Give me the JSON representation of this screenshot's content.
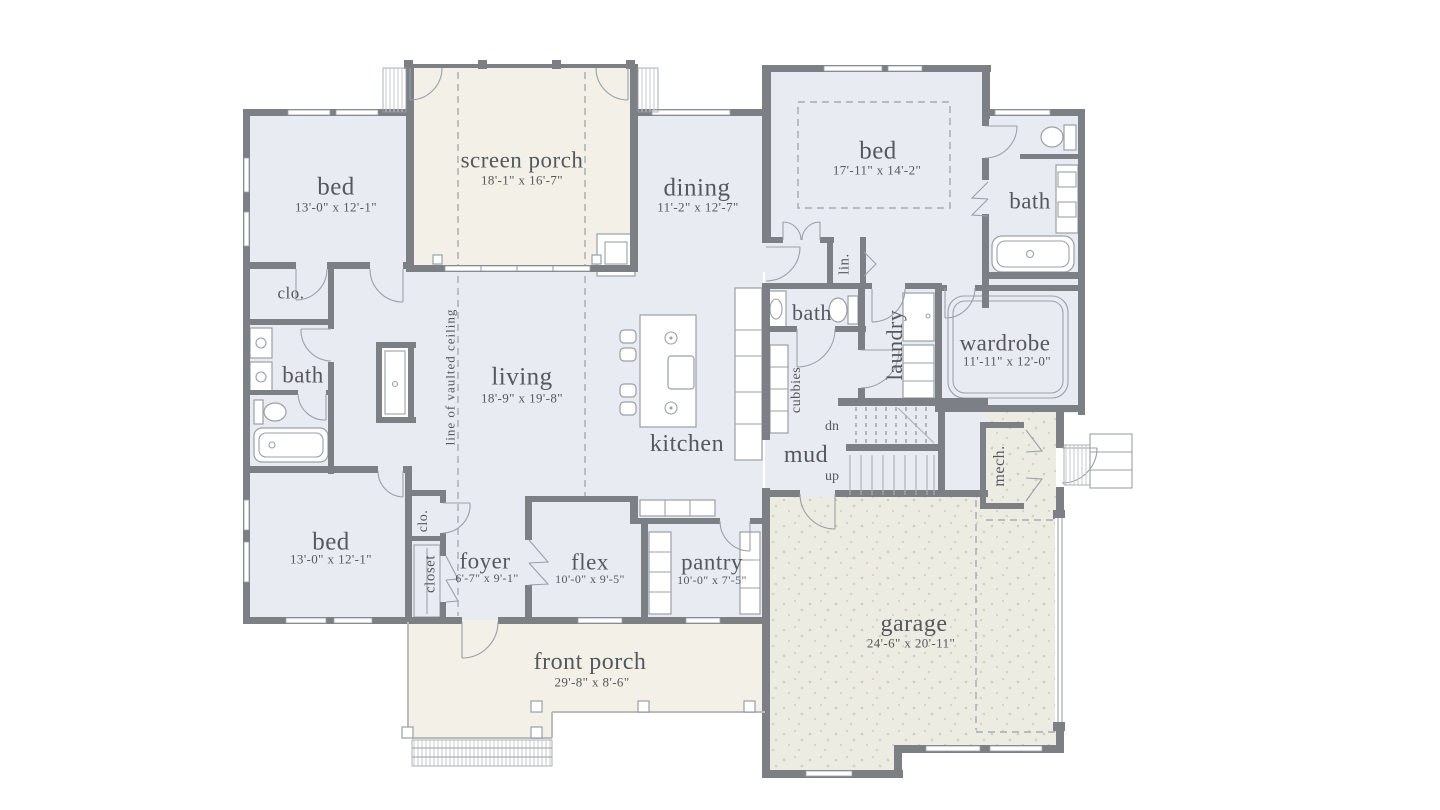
{
  "colors": {
    "wall": "#7c7f83",
    "room_fill": "#e9ebf2",
    "porch_fill": "#f2f0e7",
    "garage_fill": "#edece2",
    "text": "#55585c",
    "dash": "#a7abb1",
    "fixture": "#9aa0a8",
    "porch_edge": "#b9bcba"
  },
  "rooms": {
    "bed_upper_left": {
      "label": "bed",
      "dims": "13'-0\" x 12'-1\""
    },
    "screen_porch": {
      "label": "screen porch",
      "dims": "18'-1\" x 16'-7\""
    },
    "dining": {
      "label": "dining",
      "dims": "11'-2\" x 12'-7\""
    },
    "bed_upper_right": {
      "label": "bed",
      "dims": "17'-11\" x 14'-2\""
    },
    "bath_upper_right": {
      "label": "bath"
    },
    "clo_upper_left": {
      "label": "clo."
    },
    "bath_left": {
      "label": "bath"
    },
    "living": {
      "label": "living",
      "dims": "18'-9\" x 19'-8\""
    },
    "kitchen": {
      "label": "kitchen"
    },
    "cubbies": {
      "label": "cubbies"
    },
    "bath_center": {
      "label": "bath"
    },
    "laundry": {
      "label": "laundry"
    },
    "linen": {
      "label": "lin."
    },
    "wardrobe": {
      "label": "wardrobe",
      "dims": "11'-11\" x 12'-0\""
    },
    "mud": {
      "label": "mud"
    },
    "mech": {
      "label": "mech."
    },
    "bed_lower_left": {
      "label": "bed",
      "dims": "13'-0\" x 12'-1\""
    },
    "clo_lower": {
      "label": "clo."
    },
    "closet": {
      "label": "closet"
    },
    "foyer": {
      "label": "foyer",
      "dims": "6'-7\" x 9'-1\""
    },
    "flex": {
      "label": "flex",
      "dims": "10'-0\" x 9'-5\""
    },
    "pantry": {
      "label": "pantry",
      "dims": "10'-0\" x 7'-5\""
    },
    "garage": {
      "label": "garage",
      "dims": "24'-6\" x 20'-11\""
    },
    "front_porch": {
      "label": "front porch",
      "dims": "29'-8\" x 8'-6\""
    }
  },
  "annotations": {
    "vaulted_ceiling": "line of vaulted ceiling",
    "stair_down": "dn",
    "stair_up": "up"
  }
}
